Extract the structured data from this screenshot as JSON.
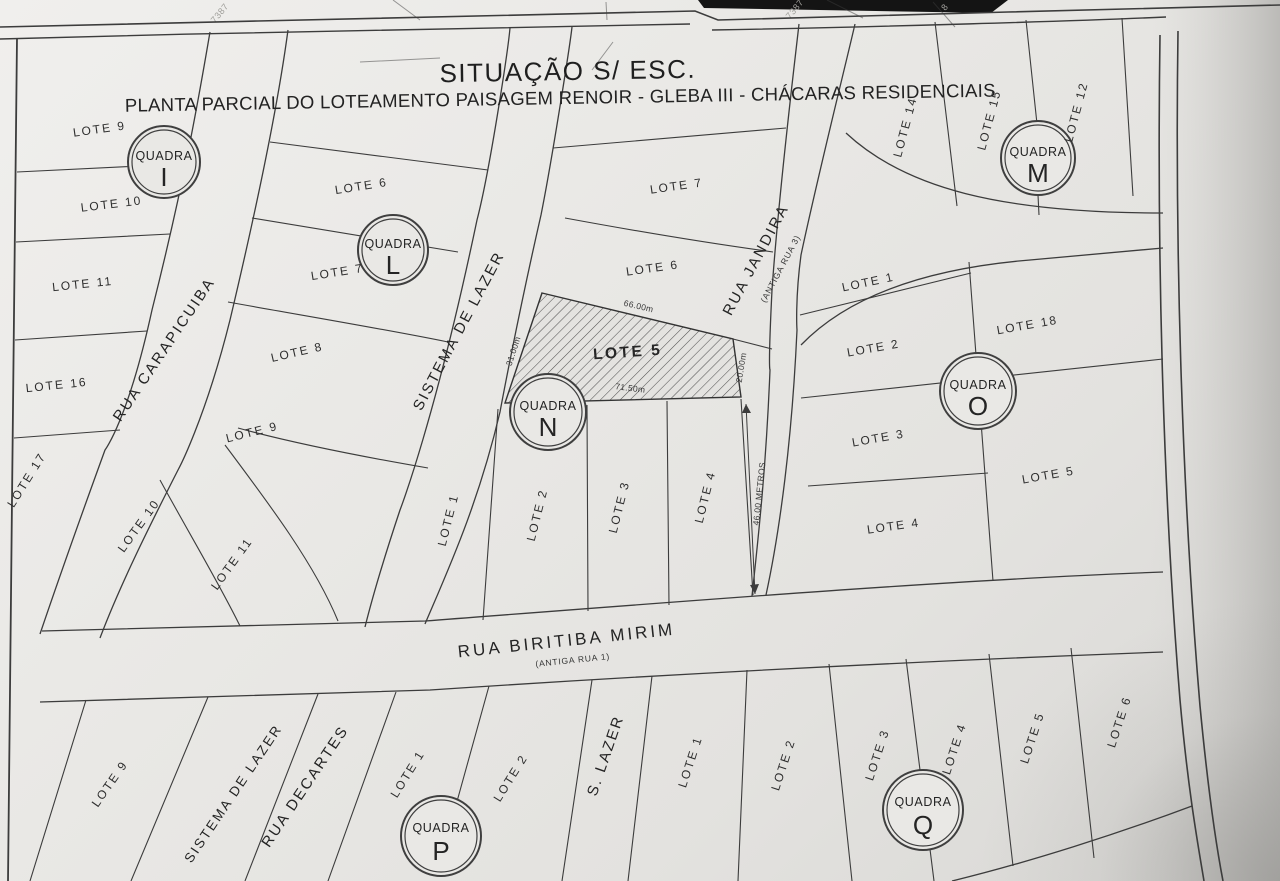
{
  "title": {
    "line1": "SITUAÇÃO S/ ESC.",
    "line2": "PLANTA PARCIAL DO LOTEAMENTO PAISAGEM RENOIR - GLEBA III - CHÁCARAS RESIDENCIAIS"
  },
  "streets": {
    "carapicuiba": "RUA CARAPICUIBA",
    "sistema_lazer_top": "SISTEMA DE LAZER",
    "jandira": "RUA JANDIRA",
    "jandira_old": "(ANTIGA RUA 3)",
    "biritiba": "RUA BIRITIBA MIRIM",
    "biritiba_old": "(ANTIGA RUA 1)",
    "sistema_lazer_bottom": "SISTEMA DE LAZER",
    "decartes": "RUA DECARTES",
    "s_lazer": "S. LAZER"
  },
  "blocks": {
    "quadra_i": {
      "circle": {
        "prefix": "QUADRA",
        "letter": "I"
      },
      "lots_west": [
        "LOTE 9",
        "LOTE 10",
        "LOTE 11",
        "LOTE 16",
        "LOTE 17"
      ],
      "lots_east": [
        "LOTE 9",
        "LOTE 10",
        "LOTE 11"
      ]
    },
    "quadra_l": {
      "circle": {
        "prefix": "QUADRA",
        "letter": "L"
      },
      "lots": [
        "LOTE 6",
        "LOTE 7",
        "LOTE 8"
      ]
    },
    "quadra_m": {
      "circle": {
        "prefix": "QUADRA",
        "letter": "M"
      },
      "lots": [
        "LOTE 14",
        "LOTE 15",
        "LOTE 12"
      ]
    },
    "quadra_n": {
      "circle": {
        "prefix": "QUADRA",
        "letter": "N"
      },
      "lots_top": [
        "LOTE 7",
        "LOTE 6"
      ],
      "highlight_lot": "LOTE 5",
      "lots_bottom": [
        "LOTE 1",
        "LOTE 2",
        "LOTE 3",
        "LOTE 4"
      ]
    },
    "quadra_o": {
      "circle": {
        "prefix": "QUADRA",
        "letter": "O"
      },
      "lots_left": [
        "LOTE 1",
        "LOTE 2",
        "LOTE 3",
        "LOTE 4"
      ],
      "lots_right": [
        "LOTE 18",
        "LOTE 5"
      ]
    },
    "quadra_p": {
      "circle": {
        "prefix": "QUADRA",
        "letter": "P"
      },
      "lots": [
        "LOTE 9",
        "LOTE 1",
        "LOTE 2"
      ]
    },
    "quadra_q": {
      "circle": {
        "prefix": "QUADRA",
        "letter": "Q"
      },
      "lots": [
        "LOTE 1",
        "LOTE 2",
        "LOTE 3",
        "LOTE 4",
        "LOTE 5",
        "LOTE 6"
      ]
    }
  },
  "dimensions": {
    "top": "66.00m",
    "left": "31.00m",
    "bottom": "71.50m",
    "right": "20.00m",
    "frontage": "46.00 METROS"
  },
  "margin_notes": [
    "7387",
    "7387",
    "8"
  ],
  "colors": {
    "paper": "#e9e8e5",
    "ink": "#3c3c3c",
    "hatch": "#555555",
    "scan_bar": "#141414"
  }
}
